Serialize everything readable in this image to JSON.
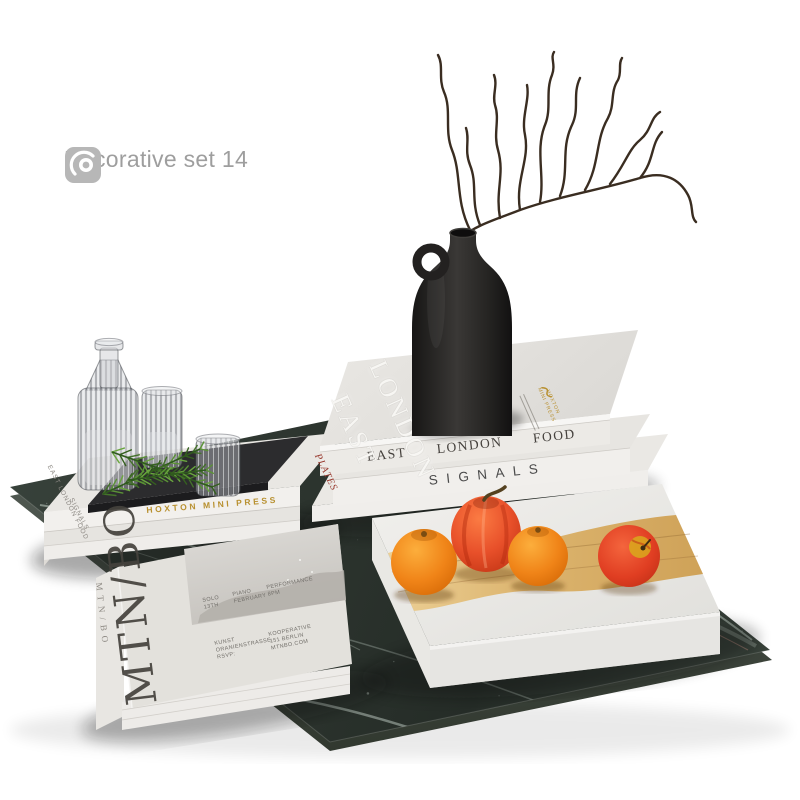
{
  "header": {
    "title": "Decorative set 14",
    "icons": [
      {
        "name": "vray-logo"
      },
      {
        "name": "corona-renderer-logo"
      }
    ]
  },
  "scene": {
    "left_stack": {
      "spine_title_top": "EAST LONDON FOOD",
      "spine_title_bottom": "SIGNALS",
      "edge_publisher": "HOXTON MINI PRESS"
    },
    "right_stack": {
      "cover_title_line1": "EAST",
      "cover_title_line2": "LONDON",
      "cover_publisher_line1": "HOXTON",
      "cover_publisher_line2": "MINI PRESS",
      "spine_book_top": "EAST LONDON FOOD",
      "spine_book_middle": "SIGNALS",
      "base_book_label": "PLATES"
    },
    "art_book": {
      "cover_title": "MTN/BO",
      "spine_title": "MTN/BO",
      "credit_1_line1": "SOLO",
      "credit_1_line2": "13TH",
      "credit_2_line1": "PIANO",
      "credit_2_line2": "FEBRUARY",
      "credit_3_line1": "PERFORMANCE",
      "credit_3_line2": "8PM",
      "credit_4_line1": "KUNST",
      "credit_4_line2": "ORANIENSTRASSE",
      "credit_4_line3": "RSVP:",
      "credit_5_line1": "KOOPERATIVE",
      "credit_5_line2": "151 BERLIN",
      "credit_5_line3": "MTNBO.COM"
    },
    "palette": {
      "marble": "#2e3631",
      "gold": "#b8902f",
      "wood": "#ddb574",
      "tangerine": "#f08418",
      "tomato_red": "#e0492a",
      "vase_black": "#262422",
      "title_gray": "#9e9e9e"
    }
  }
}
